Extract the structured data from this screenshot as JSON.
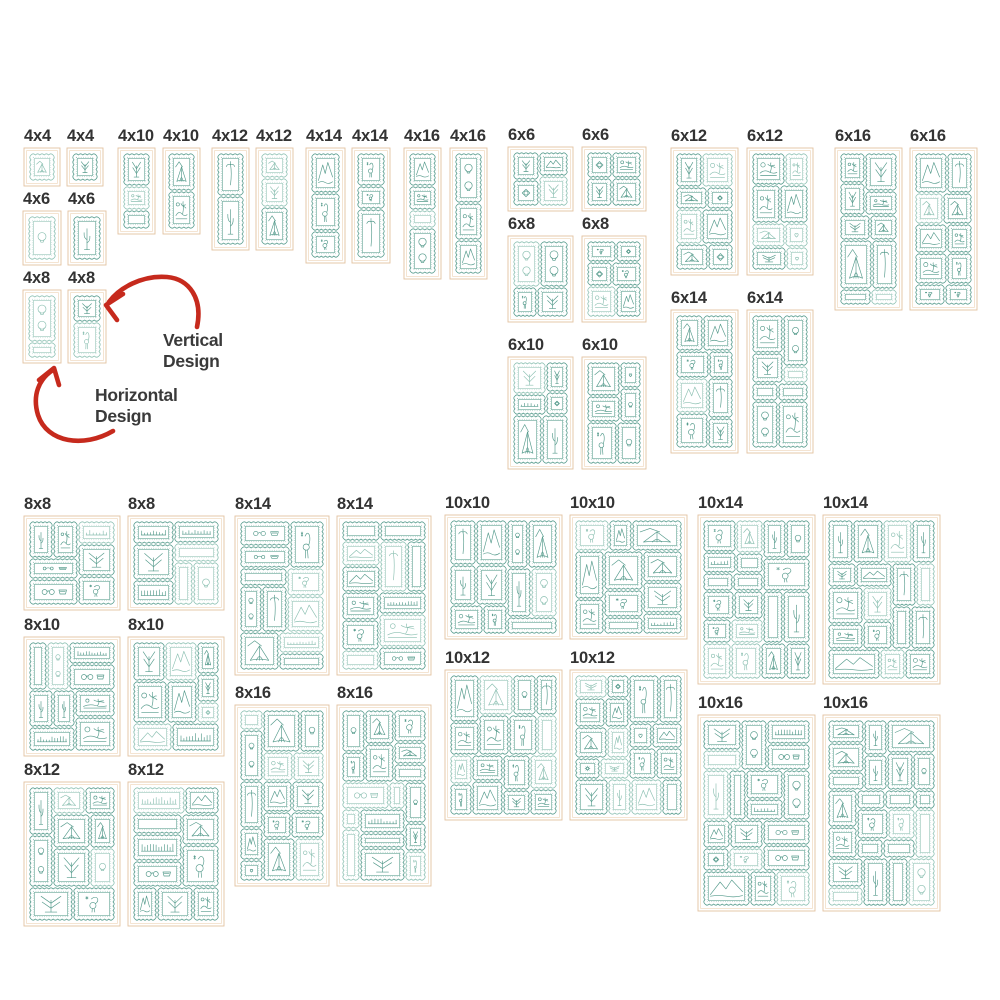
{
  "image_title": "Quilt stamp design size chart",
  "colors": {
    "background": "#ffffff",
    "stamp_teal": "#549a8b",
    "stamp_teal_light": "#8cc0b2",
    "frame_peach": "#e3c2a0",
    "frame_peach_light": "#f2ddc6",
    "label_text": "#333333",
    "arrow_red": "#c62a1d"
  },
  "annotations": {
    "vertical": {
      "line1": "Vertical",
      "line2": "Design"
    },
    "horizontal": {
      "line1": "Horizontal",
      "line2": "Design"
    }
  },
  "arrows": [
    {
      "name": "vertical-design-arrow",
      "d": "M197,327 C203,298 189,279 167,277 C142,275 119,288 109,302",
      "head": "M123,294 L106,305 L117,320"
    },
    {
      "name": "horizontal-design-arrow",
      "d": "M113,431 C84,448 47,443 38,415 C32,395 39,379 53,370",
      "head": "M39,380 L54,368 L59,385"
    }
  ],
  "panels": [
    {
      "label": "4x4",
      "variant": "horizontal",
      "x": 24,
      "y": 148,
      "w": 36,
      "h": 38
    },
    {
      "label": "4x4",
      "variant": "vertical",
      "x": 67,
      "y": 148,
      "w": 36,
      "h": 38
    },
    {
      "label": "4x6",
      "variant": "horizontal",
      "x": 23,
      "y": 211,
      "w": 38,
      "h": 54
    },
    {
      "label": "4x6",
      "variant": "vertical",
      "x": 68,
      "y": 211,
      "w": 38,
      "h": 54
    },
    {
      "label": "4x8",
      "variant": "horizontal",
      "x": 23,
      "y": 290,
      "w": 38,
      "h": 73
    },
    {
      "label": "4x8",
      "variant": "vertical",
      "x": 68,
      "y": 290,
      "w": 38,
      "h": 73
    },
    {
      "label": "4x10",
      "variant": "horizontal",
      "x": 118,
      "y": 148,
      "w": 37,
      "h": 86
    },
    {
      "label": "4x10",
      "variant": "vertical",
      "x": 163,
      "y": 148,
      "w": 37,
      "h": 86
    },
    {
      "label": "4x12",
      "variant": "horizontal",
      "x": 212,
      "y": 148,
      "w": 37,
      "h": 102
    },
    {
      "label": "4x12",
      "variant": "vertical",
      "x": 256,
      "y": 148,
      "w": 37,
      "h": 102
    },
    {
      "label": "4x14",
      "variant": "horizontal",
      "x": 306,
      "y": 148,
      "w": 39,
      "h": 115
    },
    {
      "label": "4x14",
      "variant": "vertical",
      "x": 352,
      "y": 148,
      "w": 38,
      "h": 115
    },
    {
      "label": "4x16",
      "variant": "horizontal",
      "x": 404,
      "y": 148,
      "w": 37,
      "h": 131
    },
    {
      "label": "4x16",
      "variant": "vertical",
      "x": 450,
      "y": 148,
      "w": 37,
      "h": 131
    },
    {
      "label": "6x6",
      "variant": "horizontal",
      "x": 508,
      "y": 147,
      "w": 65,
      "h": 64
    },
    {
      "label": "6x6",
      "variant": "vertical",
      "x": 582,
      "y": 147,
      "w": 64,
      "h": 64
    },
    {
      "label": "6x8",
      "variant": "horizontal",
      "x": 508,
      "y": 236,
      "w": 65,
      "h": 86
    },
    {
      "label": "6x8",
      "variant": "vertical",
      "x": 582,
      "y": 236,
      "w": 64,
      "h": 86
    },
    {
      "label": "6x10",
      "variant": "horizontal",
      "x": 508,
      "y": 357,
      "w": 65,
      "h": 112
    },
    {
      "label": "6x10",
      "variant": "vertical",
      "x": 582,
      "y": 357,
      "w": 64,
      "h": 112
    },
    {
      "label": "6x12",
      "variant": "horizontal",
      "x": 671,
      "y": 148,
      "w": 67,
      "h": 127
    },
    {
      "label": "6x12",
      "variant": "vertical",
      "x": 747,
      "y": 148,
      "w": 66,
      "h": 127
    },
    {
      "label": "6x14",
      "variant": "horizontal",
      "x": 671,
      "y": 310,
      "w": 67,
      "h": 143
    },
    {
      "label": "6x14",
      "variant": "vertical",
      "x": 747,
      "y": 310,
      "w": 66,
      "h": 143
    },
    {
      "label": "6x16",
      "variant": "horizontal",
      "x": 835,
      "y": 148,
      "w": 67,
      "h": 162
    },
    {
      "label": "6x16",
      "variant": "vertical",
      "x": 910,
      "y": 148,
      "w": 67,
      "h": 162
    },
    {
      "label": "8x8",
      "variant": "horizontal",
      "x": 24,
      "y": 516,
      "w": 96,
      "h": 94
    },
    {
      "label": "8x8",
      "variant": "vertical",
      "x": 128,
      "y": 516,
      "w": 96,
      "h": 94
    },
    {
      "label": "8x10",
      "variant": "horizontal",
      "x": 24,
      "y": 637,
      "w": 96,
      "h": 119
    },
    {
      "label": "8x10",
      "variant": "vertical",
      "x": 128,
      "y": 637,
      "w": 96,
      "h": 119
    },
    {
      "label": "8x12",
      "variant": "horizontal",
      "x": 24,
      "y": 782,
      "w": 96,
      "h": 144
    },
    {
      "label": "8x12",
      "variant": "vertical",
      "x": 128,
      "y": 782,
      "w": 96,
      "h": 144
    },
    {
      "label": "8x14",
      "variant": "horizontal",
      "x": 235,
      "y": 516,
      "w": 94,
      "h": 159
    },
    {
      "label": "8x14",
      "variant": "vertical",
      "x": 337,
      "y": 516,
      "w": 94,
      "h": 159
    },
    {
      "label": "8x16",
      "variant": "horizontal",
      "x": 235,
      "y": 705,
      "w": 94,
      "h": 181
    },
    {
      "label": "8x16",
      "variant": "vertical",
      "x": 337,
      "y": 705,
      "w": 94,
      "h": 181
    },
    {
      "label": "10x10",
      "variant": "horizontal",
      "x": 445,
      "y": 515,
      "w": 117,
      "h": 124
    },
    {
      "label": "10x10",
      "variant": "vertical",
      "x": 570,
      "y": 515,
      "w": 117,
      "h": 124
    },
    {
      "label": "10x12",
      "variant": "horizontal",
      "x": 445,
      "y": 670,
      "w": 117,
      "h": 150
    },
    {
      "label": "10x12",
      "variant": "vertical",
      "x": 570,
      "y": 670,
      "w": 117,
      "h": 150
    },
    {
      "label": "10x14",
      "variant": "horizontal",
      "x": 698,
      "y": 515,
      "w": 117,
      "h": 169
    },
    {
      "label": "10x14",
      "variant": "vertical",
      "x": 823,
      "y": 515,
      "w": 117,
      "h": 169
    },
    {
      "label": "10x16",
      "variant": "horizontal",
      "x": 698,
      "y": 715,
      "w": 117,
      "h": 196
    },
    {
      "label": "10x16",
      "variant": "vertical",
      "x": 823,
      "y": 715,
      "w": 117,
      "h": 196
    }
  ]
}
